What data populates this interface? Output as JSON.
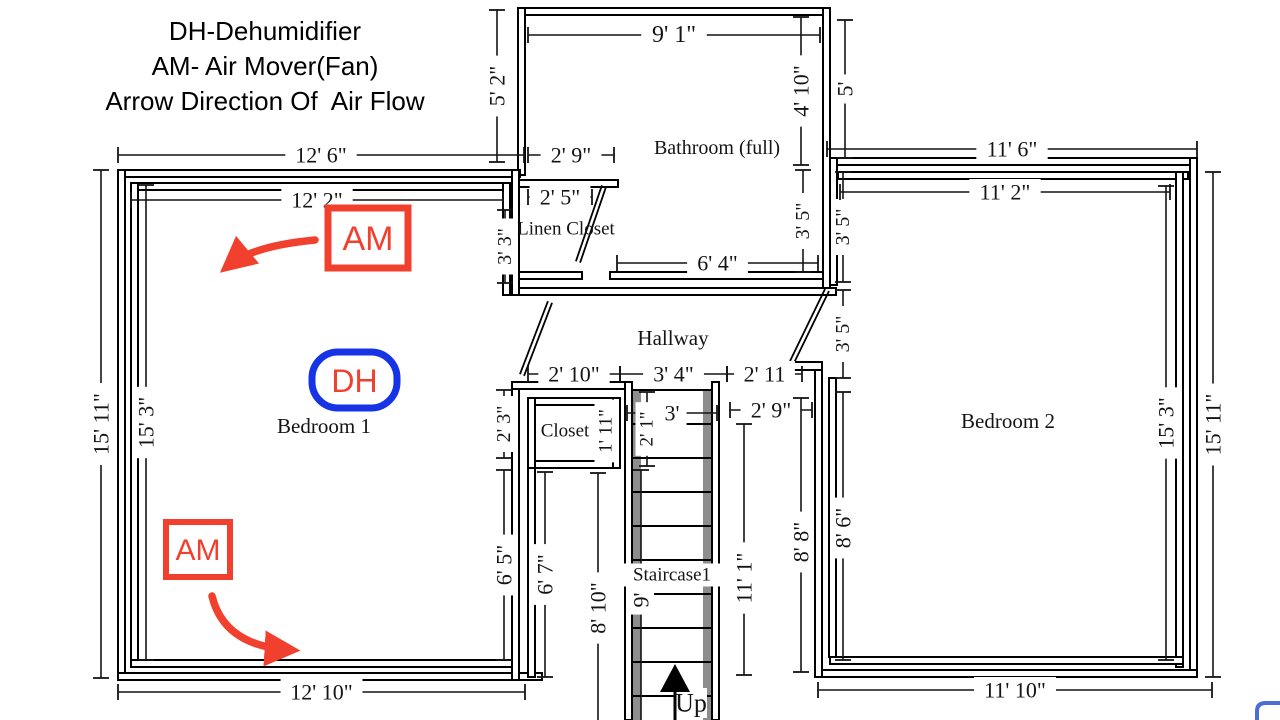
{
  "legend": {
    "line1": "DH-Dehumidifier",
    "line2": "AM- Air Mover(Fan)",
    "line3": "Arrow Direction Of  Air Flow"
  },
  "colors": {
    "red": "#f2402e",
    "blue": "#1633e6",
    "wall": "#000000",
    "dim": "#141414",
    "rail_gray": "#8d8d8d",
    "white": "#ffffff"
  },
  "plan": {
    "walls": [
      {
        "name": "wall-bathroom-top",
        "x": 518,
        "y": 8,
        "w": 312,
        "h": 7
      },
      {
        "name": "wall-bathroom-left",
        "x": 518,
        "y": 8,
        "w": 7,
        "h": 167
      },
      {
        "name": "wall-bathroom-right",
        "x": 823,
        "y": 8,
        "w": 7,
        "h": 287
      },
      {
        "name": "wall-linen-top",
        "x": 518,
        "y": 180,
        "w": 100,
        "h": 7
      },
      {
        "name": "wall-linen-bottom",
        "x": 518,
        "y": 272,
        "w": 64,
        "h": 7
      },
      {
        "name": "wall-bathroom-bottom",
        "x": 610,
        "y": 272,
        "w": 213,
        "h": 7
      },
      {
        "name": "wall-hallway-top",
        "x": 519,
        "y": 288,
        "w": 317,
        "h": 7
      },
      {
        "name": "wall-bedroom1-top-outer",
        "x": 120,
        "y": 170,
        "w": 400,
        "h": 7
      },
      {
        "name": "wall-bedroom1-top-inner",
        "x": 131,
        "y": 183,
        "w": 381,
        "h": 7
      },
      {
        "name": "wall-bedroom1-left-outer",
        "x": 118,
        "y": 170,
        "w": 7,
        "h": 510
      },
      {
        "name": "wall-bedroom1-left-inner",
        "x": 131,
        "y": 183,
        "w": 7,
        "h": 477
      },
      {
        "name": "wall-bedroom1-bottom-outer",
        "x": 118,
        "y": 673,
        "w": 424,
        "h": 7
      },
      {
        "name": "wall-bedroom1-bottom-inner",
        "x": 131,
        "y": 660,
        "w": 381,
        "h": 7
      },
      {
        "name": "wall-bedroom1-right-upper",
        "x": 512,
        "y": 170,
        "w": 7,
        "h": 125
      },
      {
        "name": "wall-bedroom1-right-inner-upper",
        "x": 503,
        "y": 183,
        "w": 7,
        "h": 112
      },
      {
        "name": "wall-bedroom1-right-lower",
        "x": 512,
        "y": 385,
        "w": 7,
        "h": 295
      },
      {
        "name": "wall-hallway-bottom-left",
        "x": 512,
        "y": 382,
        "w": 120,
        "h": 7
      },
      {
        "name": "wall-closet-top",
        "x": 528,
        "y": 398,
        "w": 92,
        "h": 7
      },
      {
        "name": "wall-closet-bottom",
        "x": 528,
        "y": 461,
        "w": 92,
        "h": 7
      },
      {
        "name": "wall-closet-left",
        "x": 528,
        "y": 398,
        "w": 7,
        "h": 70
      },
      {
        "name": "wall-closet-right",
        "x": 613,
        "y": 398,
        "w": 7,
        "h": 70
      },
      {
        "name": "wall-nook-left",
        "x": 528,
        "y": 468,
        "w": 7,
        "h": 209
      },
      {
        "name": "wall-stair-left",
        "x": 625,
        "y": 382,
        "w": 7,
        "h": 338
      },
      {
        "name": "wall-stair-right",
        "x": 712,
        "y": 382,
        "w": 7,
        "h": 338
      },
      {
        "name": "wall-bedroom2-top-outer",
        "x": 830,
        "y": 158,
        "w": 367,
        "h": 7
      },
      {
        "name": "wall-bedroom2-top-inner",
        "x": 838,
        "y": 172,
        "w": 350,
        "h": 7
      },
      {
        "name": "wall-bedroom2-right-outer",
        "x": 1190,
        "y": 158,
        "w": 7,
        "h": 519
      },
      {
        "name": "wall-bedroom2-right-inner",
        "x": 1176,
        "y": 172,
        "w": 7,
        "h": 495
      },
      {
        "name": "wall-bedroom2-bottom-outer",
        "x": 815,
        "y": 670,
        "w": 382,
        "h": 7
      },
      {
        "name": "wall-bedroom2-bottom-inner",
        "x": 830,
        "y": 657,
        "w": 353,
        "h": 7
      },
      {
        "name": "wall-bedroom2-left-upper",
        "x": 830,
        "y": 158,
        "w": 7,
        "h": 127
      },
      {
        "name": "wall-bedroom2-left-lower-outer",
        "x": 815,
        "y": 366,
        "w": 7,
        "h": 311
      },
      {
        "name": "wall-bedroom2-left-lower-inner",
        "x": 829,
        "y": 378,
        "w": 7,
        "h": 279
      },
      {
        "name": "wall-bedroom2-door-stub",
        "x": 786,
        "y": 362,
        "w": 36,
        "h": 8
      }
    ],
    "stair": {
      "name": "staircase",
      "x": 632,
      "w": 80,
      "top": 382,
      "bottom": 720,
      "rail1": 633,
      "rail2": 703,
      "rail_w": 8,
      "rail_top": 390,
      "steps_from": 390,
      "steps_to": 716,
      "step_gap": 34
    },
    "doors": [
      {
        "name": "door-linen-closet",
        "x1": 604,
        "y1": 186,
        "x2": 578,
        "y2": 262
      },
      {
        "name": "door-bedroom1",
        "x1": 550,
        "y1": 302,
        "x2": 522,
        "y2": 375
      },
      {
        "name": "door-bedroom2",
        "x1": 827,
        "y1": 290,
        "x2": 792,
        "y2": 362
      }
    ],
    "dims": [
      {
        "name": "dim-bedroom1-top-outer",
        "label": "12' 6\"",
        "x1": 118,
        "y1": 155,
        "x2": 524,
        "y2": 155
      },
      {
        "name": "dim-bedroom1-top-inner",
        "label": "12' 2\"",
        "x1": 131,
        "y1": 200,
        "x2": 503,
        "y2": 200
      },
      {
        "name": "dim-bedroom1-left-outer",
        "label": "15' 11\"",
        "x1": 101,
        "y1": 170,
        "x2": 101,
        "y2": 678,
        "rot": true
      },
      {
        "name": "dim-bedroom1-left-inner",
        "label": "15' 3\"",
        "x1": 146,
        "y1": 185,
        "x2": 146,
        "y2": 660,
        "rot": true
      },
      {
        "name": "dim-bedroom1-bottom",
        "label": "12' 10\"",
        "x1": 118,
        "y1": 692,
        "x2": 525,
        "y2": 692
      },
      {
        "name": "dim-bedroom1-right-upper",
        "label": "2' 3\"",
        "x1": 504,
        "y1": 390,
        "x2": 504,
        "y2": 458,
        "rot": true,
        "fs": 20
      },
      {
        "name": "dim-bedroom1-right-lower",
        "label": "6' 5\"",
        "x1": 504,
        "y1": 470,
        "x2": 504,
        "y2": 660,
        "rot": true
      },
      {
        "name": "dim-nook-height",
        "label": "6' 7\"",
        "x1": 545,
        "y1": 472,
        "x2": 545,
        "y2": 677,
        "rot": true
      },
      {
        "name": "dim-stair-left",
        "label": "8' 10\"",
        "x1": 598,
        "y1": 473,
        "x2": 598,
        "y2": 720,
        "rot": true,
        "ticks": "start",
        "ly": 608
      },
      {
        "name": "dim-bath-left",
        "label": "5' 2\"",
        "x1": 497,
        "y1": 10,
        "x2": 497,
        "y2": 162,
        "rot": true
      },
      {
        "name": "dim-bath-top",
        "label": "9' 1\"",
        "x1": 528,
        "y1": 35,
        "x2": 820,
        "y2": 35,
        "fs": 24
      },
      {
        "name": "dim-bath-right",
        "label": "4' 10\"",
        "x1": 801,
        "y1": 17,
        "x2": 801,
        "y2": 165,
        "rot": true
      },
      {
        "name": "dim-right-top",
        "label": "5'",
        "x1": 845,
        "y1": 20,
        "x2": 845,
        "y2": 158,
        "rot": true
      },
      {
        "name": "dim-linen-top",
        "label": "2' 9\"",
        "x1": 528,
        "y1": 155,
        "x2": 614,
        "y2": 155
      },
      {
        "name": "dim-linen-inner",
        "label": "2' 5\"",
        "x1": 528,
        "y1": 197,
        "x2": 592,
        "y2": 197
      },
      {
        "name": "dim-linen-left",
        "label": "3' 3\"",
        "x1": 505,
        "y1": 210,
        "x2": 505,
        "y2": 283,
        "rot": true,
        "fs": 20
      },
      {
        "name": "dim-bath-bottom",
        "label": "6' 4\"",
        "x1": 617,
        "y1": 263,
        "x2": 818,
        "y2": 263
      },
      {
        "name": "dim-bath-right-lower",
        "label": "3' 5\"",
        "x1": 803,
        "y1": 170,
        "x2": 803,
        "y2": 272,
        "rot": true,
        "fs": 20
      },
      {
        "name": "dim-bedroom2-left-upper",
        "label": "3' 5\"",
        "x1": 843,
        "y1": 172,
        "x2": 843,
        "y2": 282,
        "rot": true,
        "fs": 20
      },
      {
        "name": "dim-bedroom2-left-mid",
        "label": "3' 5\"",
        "x1": 843,
        "y1": 290,
        "x2": 843,
        "y2": 378,
        "rot": true,
        "fs": 20
      },
      {
        "name": "dim-hallway-left",
        "label": "2' 10\"",
        "x1": 528,
        "y1": 374,
        "x2": 620,
        "y2": 374
      },
      {
        "name": "dim-hallway-mid",
        "label": "3' 4\"",
        "x1": 620,
        "y1": 374,
        "x2": 727,
        "y2": 374
      },
      {
        "name": "dim-hallway-right",
        "label": "2' 11",
        "x1": 727,
        "y1": 374,
        "x2": 802,
        "y2": 374
      },
      {
        "name": "dim-closet-height",
        "label": "1' 11\"",
        "x1": 606,
        "y1": 402,
        "x2": 606,
        "y2": 460,
        "rot": true,
        "fs": 19
      },
      {
        "name": "dim-stair-width",
        "label": "3'",
        "x1": 627,
        "y1": 413,
        "x2": 717,
        "y2": 413
      },
      {
        "name": "dim-stair-upper",
        "label": "2' 1\"",
        "x1": 647,
        "y1": 392,
        "x2": 647,
        "y2": 466,
        "rot": true,
        "fs": 19
      },
      {
        "name": "dim-stair-run",
        "label": "9'",
        "x1": 641,
        "y1": 470,
        "x2": 641,
        "y2": 720,
        "rot": true,
        "ticks": "start",
        "ly": 600
      },
      {
        "name": "dim-corridor-width",
        "label": "2' 9\"",
        "x1": 730,
        "y1": 410,
        "x2": 812,
        "y2": 410
      },
      {
        "name": "dim-corridor-height",
        "label": "11' 1\"",
        "x1": 744,
        "y1": 424,
        "x2": 744,
        "y2": 675,
        "rot": true,
        "ly": 578
      },
      {
        "name": "dim-bedroom2-leftwall-outer",
        "label": "8' 8\"",
        "x1": 801,
        "y1": 398,
        "x2": 801,
        "y2": 672,
        "rot": true,
        "ly": 542
      },
      {
        "name": "dim-bedroom2-leftwall-inner",
        "label": "8' 6\"",
        "x1": 843,
        "y1": 392,
        "x2": 843,
        "y2": 660,
        "rot": true,
        "ly": 528
      },
      {
        "name": "dim-bedroom2-top-outer",
        "label": "11' 6\"",
        "x1": 827,
        "y1": 149,
        "x2": 1197,
        "y2": 149
      },
      {
        "name": "dim-bedroom2-top-inner",
        "label": "11' 2\"",
        "x1": 840,
        "y1": 192,
        "x2": 1170,
        "y2": 192
      },
      {
        "name": "dim-bedroom2-right-inner",
        "label": "15' 3\"",
        "x1": 1166,
        "y1": 186,
        "x2": 1166,
        "y2": 660,
        "rot": true
      },
      {
        "name": "dim-bedroom2-right-outer",
        "label": "15' 11\"",
        "x1": 1213,
        "y1": 172,
        "x2": 1213,
        "y2": 677,
        "rot": true
      },
      {
        "name": "dim-bedroom2-bottom",
        "label": "11' 10\"",
        "x1": 818,
        "y1": 690,
        "x2": 1212,
        "y2": 690
      }
    ],
    "room_labels": [
      {
        "name": "label-bathroom",
        "text": "Bathroom (full)",
        "x": 717,
        "y": 148,
        "fs": 20
      },
      {
        "name": "label-linen-closet",
        "text": "Linen Closet",
        "x": 566,
        "y": 229,
        "fs": 19
      },
      {
        "name": "label-hallway",
        "text": "Hallway",
        "x": 673,
        "y": 338,
        "fs": 21
      },
      {
        "name": "label-bedroom1",
        "text": "Bedroom 1",
        "x": 324,
        "y": 426,
        "fs": 21
      },
      {
        "name": "label-closet",
        "text": "Closet",
        "x": 565,
        "y": 431,
        "fs": 19
      },
      {
        "name": "label-staircase",
        "text": "Staircase1",
        "x": 672,
        "y": 575,
        "fs": 19,
        "bg": true
      },
      {
        "name": "label-bedroom2",
        "text": "Bedroom 2",
        "x": 1008,
        "y": 421,
        "fs": 21
      },
      {
        "name": "label-up",
        "text": "Up",
        "x": 691,
        "y": 703,
        "fs": 26,
        "bg": true
      }
    ]
  },
  "annotations": {
    "am_text": "AM",
    "dh_text": "DH",
    "am_boxes": [
      {
        "name": "am-unit-1",
        "x": 328,
        "y": 208,
        "w": 80,
        "h": 60,
        "fs": 34,
        "bw": 7
      },
      {
        "name": "am-unit-2",
        "x": 166,
        "y": 522,
        "w": 64,
        "h": 55,
        "fs": 30,
        "bw": 6
      }
    ],
    "dh_box": {
      "name": "dh-unit",
      "x": 312,
      "y": 352,
      "w": 85,
      "h": 56,
      "rx": 26,
      "fs": 32,
      "bw": 7
    },
    "flow_arrows": [
      {
        "name": "airflow-arrow-1",
        "d": "M 315 240 Q 252 246 228 266"
      },
      {
        "name": "airflow-arrow-2",
        "d": "M 212 596 Q 224 646 290 650"
      }
    ],
    "up_arrow": {
      "name": "up-arrow",
      "stem": [
        675,
        720,
        675,
        690
      ],
      "head": [
        [
          675,
          664
        ],
        [
          660,
          692
        ],
        [
          690,
          692
        ]
      ]
    },
    "corner_fragment": {
      "name": "blue-corner-fragment",
      "d": "M 1257 722 L 1257 711 Q 1257 703 1266 703 L 1281 703"
    }
  }
}
